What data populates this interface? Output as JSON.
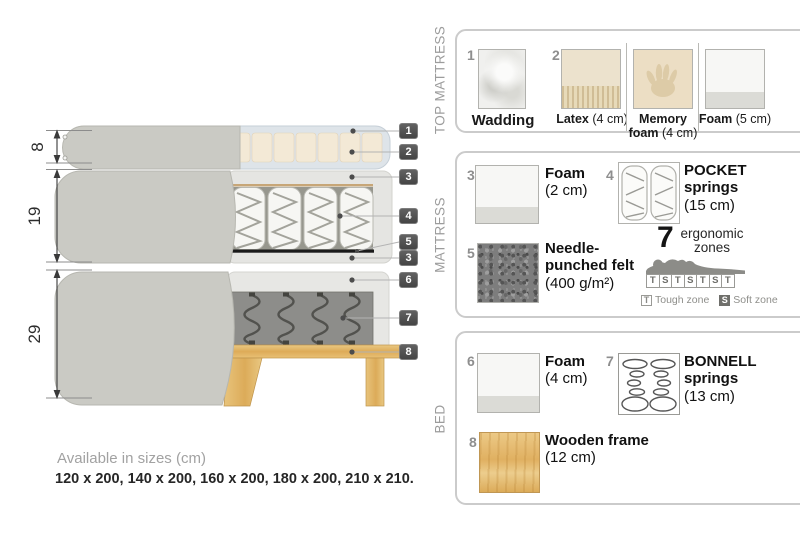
{
  "diagram": {
    "dim_top": "8",
    "dim_mid": "19",
    "dim_bottom": "29",
    "callouts": [
      "1",
      "2",
      "3",
      "4",
      "5",
      "3",
      "6",
      "7",
      "8"
    ]
  },
  "legend": {
    "top_mattress": {
      "section_label": "TOP MATTRESS",
      "item1": {
        "num": "1",
        "name": "Wadding"
      },
      "item2_num": "2",
      "options": [
        {
          "name": "Latex",
          "size": "(4 cm)"
        },
        {
          "name": "Memory foam",
          "size": "(4 cm)"
        },
        {
          "name": "Foam",
          "size": "(5 cm)"
        }
      ]
    },
    "mattress": {
      "section_label": "MATTRESS",
      "items": [
        {
          "num": "3",
          "name": "Foam",
          "size": "(2 cm)"
        },
        {
          "num": "4",
          "name": "POCKET springs",
          "size": "(15 cm)"
        },
        {
          "num": "5",
          "name": "Needle-punched felt",
          "size": "(400 g/m²)"
        }
      ],
      "ergonomic": {
        "number": "7",
        "label_line1": "ergonomic",
        "label_line2": "zones",
        "zones": [
          "T",
          "S",
          "T",
          "S",
          "T",
          "S",
          "T"
        ],
        "tough_symbol": "T",
        "tough_label": "Tough zone",
        "soft_symbol": "S",
        "soft_label": "Soft zone"
      }
    },
    "bed": {
      "section_label": "BED",
      "items": [
        {
          "num": "6",
          "name": "Foam",
          "size": "(4 cm)"
        },
        {
          "num": "7",
          "name": "BONNELL springs",
          "size": "(13 cm)"
        },
        {
          "num": "8",
          "name": "Wooden frame",
          "size": "(12 cm)"
        }
      ]
    }
  },
  "footer": {
    "title": "Available in sizes (cm)",
    "sizes": "120 x 200, 140 x 200, 160 x 200, 180 x 200, 210 x 210."
  },
  "colors": {
    "fabric_gray": "#cacac4",
    "wadding_blue": "#dee4e9",
    "latex_cream": "#f3e9d6",
    "foam_light": "#e5e5e2",
    "felt_black": "#1a1a1a",
    "bonnell_gray": "#8d8d8a",
    "wood_tan": "#ddab58",
    "callout_bg": "#4f4f4f",
    "panel_border": "#cbcbcb",
    "label_gray": "#9c9c9c"
  }
}
